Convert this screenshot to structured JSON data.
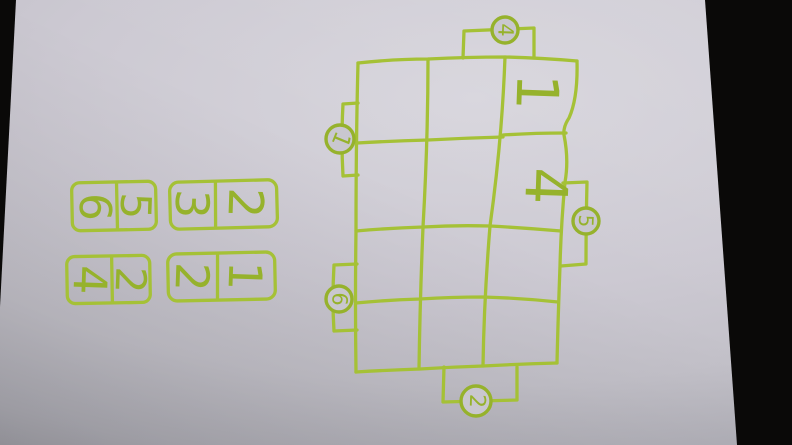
{
  "photo": {
    "subject": "hand-drawn marker puzzle on paper",
    "marker_color": "#a5c136",
    "paper_color": "#c9c7cf",
    "table_color": "#0a0908",
    "digit_orientation": "all digits are written rotated 90 degrees clockwise"
  },
  "board": {
    "rows": 4,
    "cols": 3,
    "cells": [
      {
        "row": 1,
        "col": 3,
        "value": "1"
      },
      {
        "row": 2,
        "col": 3,
        "value": "4"
      }
    ],
    "tabs": [
      {
        "side": "top",
        "value": "4"
      },
      {
        "side": "left-upper",
        "value": "1"
      },
      {
        "side": "left-lower",
        "value": "6"
      },
      {
        "side": "right",
        "value": "5"
      },
      {
        "side": "bottom",
        "value": "2"
      }
    ]
  },
  "dominoes": [
    {
      "left_value": "6",
      "right_value": "5",
      "pair_upright": "5/6"
    },
    {
      "left_value": "3",
      "right_value": "2",
      "pair_upright": "2/3"
    },
    {
      "left_value": "4",
      "right_value": "2",
      "pair_upright": "2/4"
    },
    {
      "left_value": "2",
      "right_value": "1",
      "pair_upright": "1/2"
    }
  ]
}
